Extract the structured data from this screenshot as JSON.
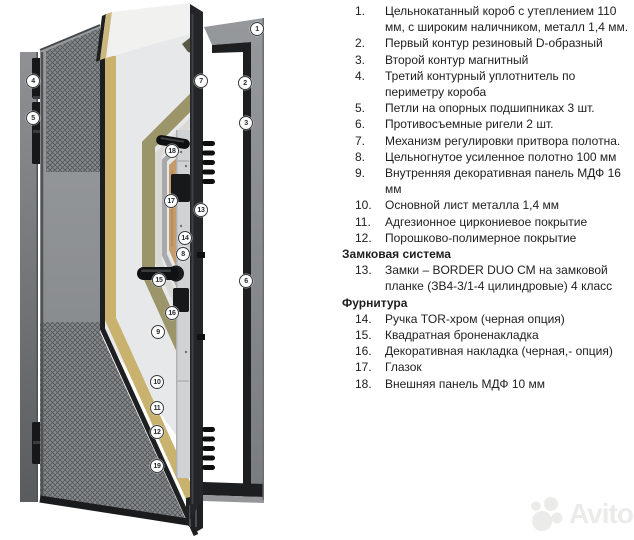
{
  "illustration": {
    "callouts": [
      {
        "n": "1",
        "x": 257,
        "y": 29
      },
      {
        "n": "2",
        "x": 245,
        "y": 83
      },
      {
        "n": "3",
        "x": 246,
        "y": 123
      },
      {
        "n": "4",
        "x": 33,
        "y": 81
      },
      {
        "n": "5",
        "x": 33,
        "y": 118
      },
      {
        "n": "6",
        "x": 246,
        "y": 281
      },
      {
        "n": "7",
        "x": 201,
        "y": 81
      },
      {
        "n": "8",
        "x": 183,
        "y": 254
      },
      {
        "n": "9",
        "x": 158,
        "y": 332
      },
      {
        "n": "10",
        "x": 157,
        "y": 382
      },
      {
        "n": "11",
        "x": 157,
        "y": 408
      },
      {
        "n": "12",
        "x": 157,
        "y": 432
      },
      {
        "n": "13",
        "x": 201,
        "y": 210
      },
      {
        "n": "14",
        "x": 185,
        "y": 238
      },
      {
        "n": "15",
        "x": 159,
        "y": 280
      },
      {
        "n": "16",
        "x": 172,
        "y": 313
      },
      {
        "n": "17",
        "x": 171,
        "y": 201
      },
      {
        "n": "18",
        "x": 172,
        "y": 151
      },
      {
        "n": "19",
        "x": 157,
        "y": 466
      }
    ]
  },
  "spec_list": {
    "entries": [
      {
        "type": "item",
        "number": "1.",
        "text": "Цельнокатанный короб с утеплением 110 мм, с широким наличником, металл 1,4 мм."
      },
      {
        "type": "item",
        "number": "2.",
        "text": "Первый контур резиновый D-образный"
      },
      {
        "type": "item",
        "number": "3.",
        "text": "Второй контур магнитный"
      },
      {
        "type": "item",
        "number": "4.",
        "text": "Третий контурный уплотнитель по периметру короба"
      },
      {
        "type": "item",
        "number": "5.",
        "text": "Петли на опорных подшипниках 3 шт."
      },
      {
        "type": "item",
        "number": "6.",
        "text": "Противосъемные ригели 2 шт."
      },
      {
        "type": "item",
        "number": "7.",
        "text": "Механизм регулировки притвора полотна."
      },
      {
        "type": "item",
        "number": "8.",
        "text": "Цельногнутое усиленное полотно 100 мм"
      },
      {
        "type": "item",
        "number": "9.",
        "text": "Внутренняя декоративная панель МДФ 16 мм"
      },
      {
        "type": "item",
        "number": "10.",
        "text": "Основной лист металла 1,4 мм"
      },
      {
        "type": "item",
        "number": "11.",
        "text": "Адгезионное циркониевое покрытие"
      },
      {
        "type": "item",
        "number": "12.",
        "text": "Порошково-полимерное покрытие"
      },
      {
        "type": "heading",
        "text": "Замковая система"
      },
      {
        "type": "item",
        "number": "13.",
        "text": "Замки – BORDER DUO СМ на замковой планке (ЗВ4-3/1-4 цилиндровые) 4 класс"
      },
      {
        "type": "heading",
        "text": "Фурнитура"
      },
      {
        "type": "item",
        "number": "14.",
        "text": "Ручка TOR-хром (черная опция)"
      },
      {
        "type": "item",
        "number": "15.",
        "text": "Квадратная броненакладка"
      },
      {
        "type": "item",
        "number": "16.",
        "text": "Декоративная накладка (черная,- опция)"
      },
      {
        "type": "item",
        "number": "17.",
        "text": "Глазок"
      },
      {
        "type": "item",
        "number": "18.",
        "text": "Внешняя панель МДФ 10 мм"
      }
    ]
  },
  "watermark": {
    "text": "Avito"
  },
  "colors": {
    "text": "#1e1e1e",
    "watermark": "#ebebe9",
    "badge_ring": "#35383a",
    "face": "#94979a",
    "hatch_line": "#54575a",
    "band_black": "#1d1f20",
    "band_tan": "#c8b26e",
    "band_white": "#e7e8e9",
    "band_olive": "#9b9569",
    "band_pale": "#dad9d5",
    "band_gray": "#a7a9ab",
    "wood": "#c59b6c",
    "plate": "#d0d2d4",
    "frame_gray": "#8d9093",
    "hardware": "#101112"
  }
}
